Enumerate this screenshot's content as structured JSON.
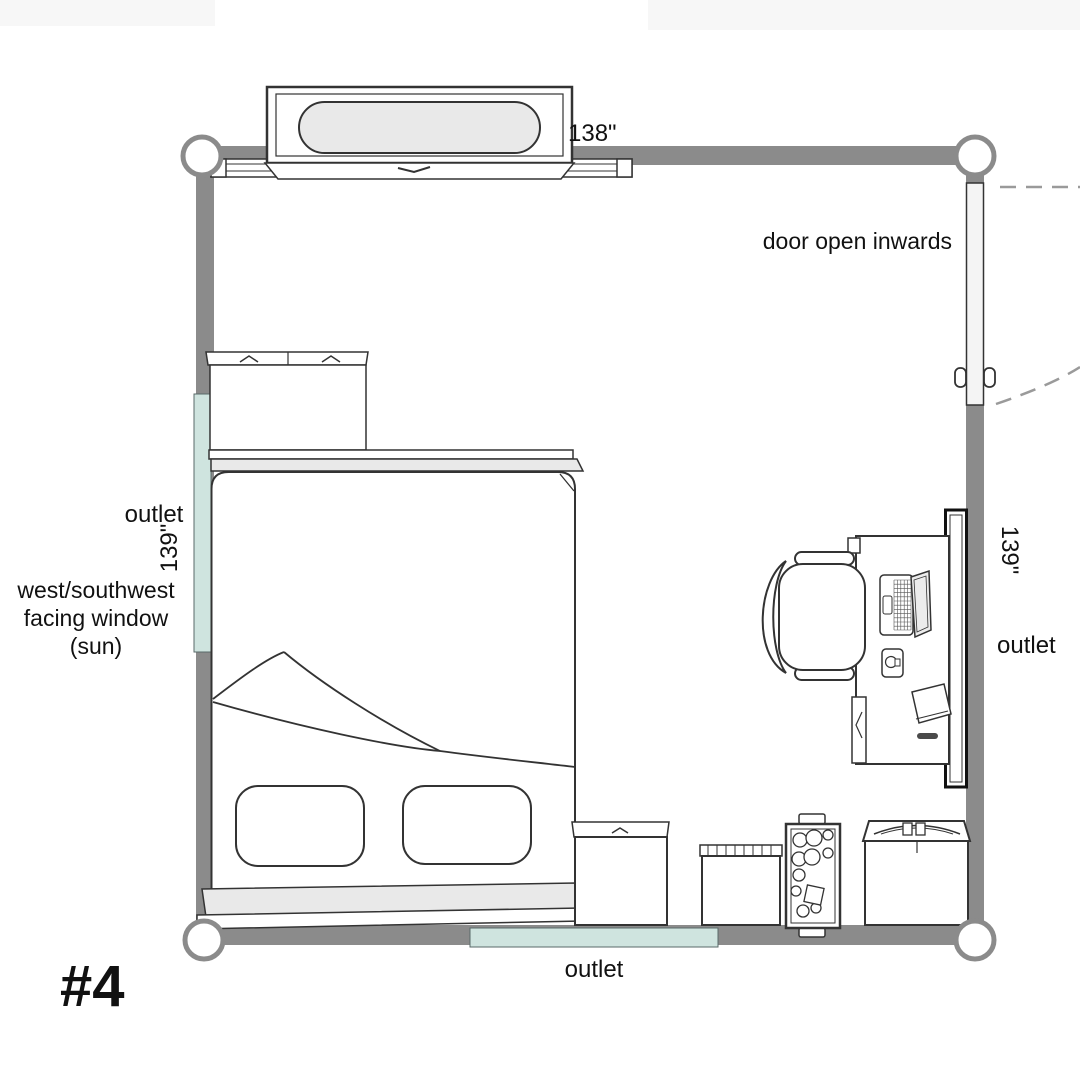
{
  "title": {
    "plan_number": "#4"
  },
  "colors": {
    "wall": "#8b8b8b",
    "window": "#cfe4df",
    "outlet_strip": "#cfe4df",
    "furniture_fill": "#e9e9e9",
    "accent_text": "#cc6152",
    "label_text": "#111111"
  },
  "labels": {
    "door_note": "door open inwards",
    "dim_top": "138\"",
    "dim_left": "139\"",
    "dim_right": "139\"",
    "outlet_left": "outlet",
    "outlet_right": "outlet",
    "outlet_bottom": "outlet",
    "window_note_line1": "west/southwest",
    "window_note_line2": "facing window",
    "window_note_line3": "(sun)"
  },
  "furniture_icons": [
    "wall-shelf",
    "top-window-rail",
    "dresser",
    "bed",
    "pillow",
    "pillow",
    "left-window",
    "desk",
    "office-chair",
    "laptop",
    "mug",
    "paper-sheet",
    "bookshelf",
    "storage-cabinet",
    "laundry-hamper",
    "rolling-cart",
    "mini-fridge",
    "door-leaf",
    "door-swing-arc",
    "outlet-strip"
  ]
}
